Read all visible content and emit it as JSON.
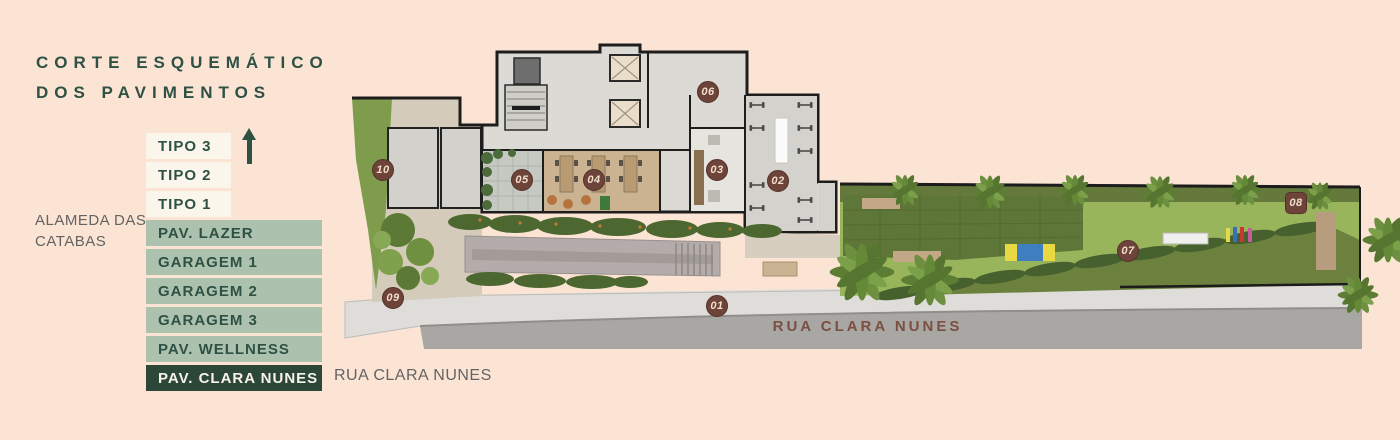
{
  "title": {
    "line1": "CORTE ESQUEMÁTICO",
    "line2": "DOS PAVIMENTOS"
  },
  "side_label": {
    "line1": "ALAMEDA DAS",
    "line2": "CATABAS"
  },
  "legend": {
    "items": [
      {
        "label": "TIPO 3",
        "style": "cream"
      },
      {
        "label": "TIPO 2",
        "style": "cream"
      },
      {
        "label": "TIPO 1",
        "style": "cream"
      },
      {
        "label": "PAV. LAZER",
        "style": "sage"
      },
      {
        "label": "GARAGEM 1",
        "style": "sage"
      },
      {
        "label": "GARAGEM 2",
        "style": "sage"
      },
      {
        "label": "GARAGEM 3",
        "style": "sage"
      },
      {
        "label": "PAV. WELLNESS",
        "style": "sage"
      },
      {
        "label": "PAV. CLARA NUNES",
        "style": "dark"
      }
    ]
  },
  "street_note": "RUA CLARA NUNES",
  "plan": {
    "street_label": "RUA CLARA NUNES",
    "markers": [
      {
        "label": "01",
        "x": 717,
        "y": 306
      },
      {
        "label": "02",
        "x": 778,
        "y": 181
      },
      {
        "label": "03",
        "x": 717,
        "y": 170
      },
      {
        "label": "04",
        "x": 594,
        "y": 180
      },
      {
        "label": "05",
        "x": 522,
        "y": 180
      },
      {
        "label": "06",
        "x": 708,
        "y": 92
      },
      {
        "label": "07",
        "x": 1128,
        "y": 251
      },
      {
        "label": "08",
        "x": 1296,
        "y": 203,
        "shape": "square"
      },
      {
        "label": "09",
        "x": 393,
        "y": 298
      },
      {
        "label": "10",
        "x": 383,
        "y": 170
      }
    ]
  },
  "colors": {
    "background": "#fbe4d4",
    "title_green": "#2e5144",
    "legend_sage": "#adc2ae",
    "legend_dark": "#2c4737",
    "marker_brown": "#6d433a",
    "street_label_brown": "#7b4f42"
  }
}
